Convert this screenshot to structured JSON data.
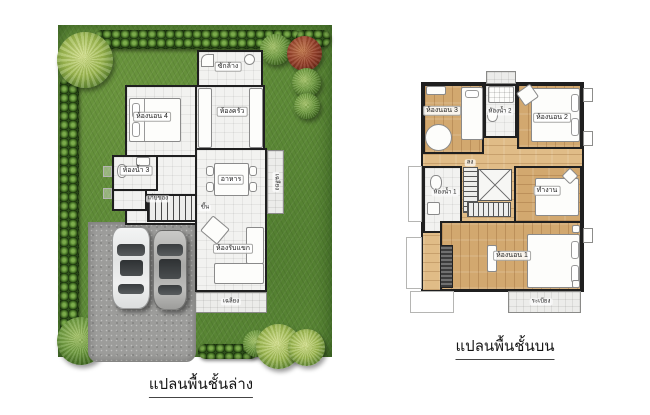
{
  "colors": {
    "wall": "#1f1f1f",
    "grass": "#5d8a37",
    "hedge": "#2d4f1b",
    "tree_green": "#6f9c40",
    "tree_red": "#96402a",
    "driveway": "#9c9c9a",
    "tile": "#f2f2f0",
    "wood": "#d2a86f",
    "porch": "#ececea"
  },
  "ground_floor": {
    "caption": "แปลนพื้นชั้นล่าง",
    "labels": {
      "bedroom4": "ห้องนอน 4",
      "laundry": "ซักล้าง",
      "kitchen": "ห้องครัว",
      "dining": "อาหาร",
      "bathroom3": "ห้องน้ำ 3",
      "storage": "เก็บของ",
      "stairs_up": "ขึ้น",
      "living": "ห้องรับแขก",
      "porch_side": "เฉลียง",
      "porch_front": "เฉลียง"
    }
  },
  "upper_floor": {
    "caption": "แปลนพื้นชั้นบน",
    "labels": {
      "bedroom3": "ห้องนอน 3",
      "bathroom2": "ห้องน้ำ 2",
      "bedroom2": "ห้องนอน 2",
      "bathroom1": "ห้องน้ำ 1",
      "stairs_down": "ลง",
      "work": "ทำงาน",
      "bedroom1": "ห้องนอน 1",
      "balcony": "ระเบียง"
    }
  }
}
